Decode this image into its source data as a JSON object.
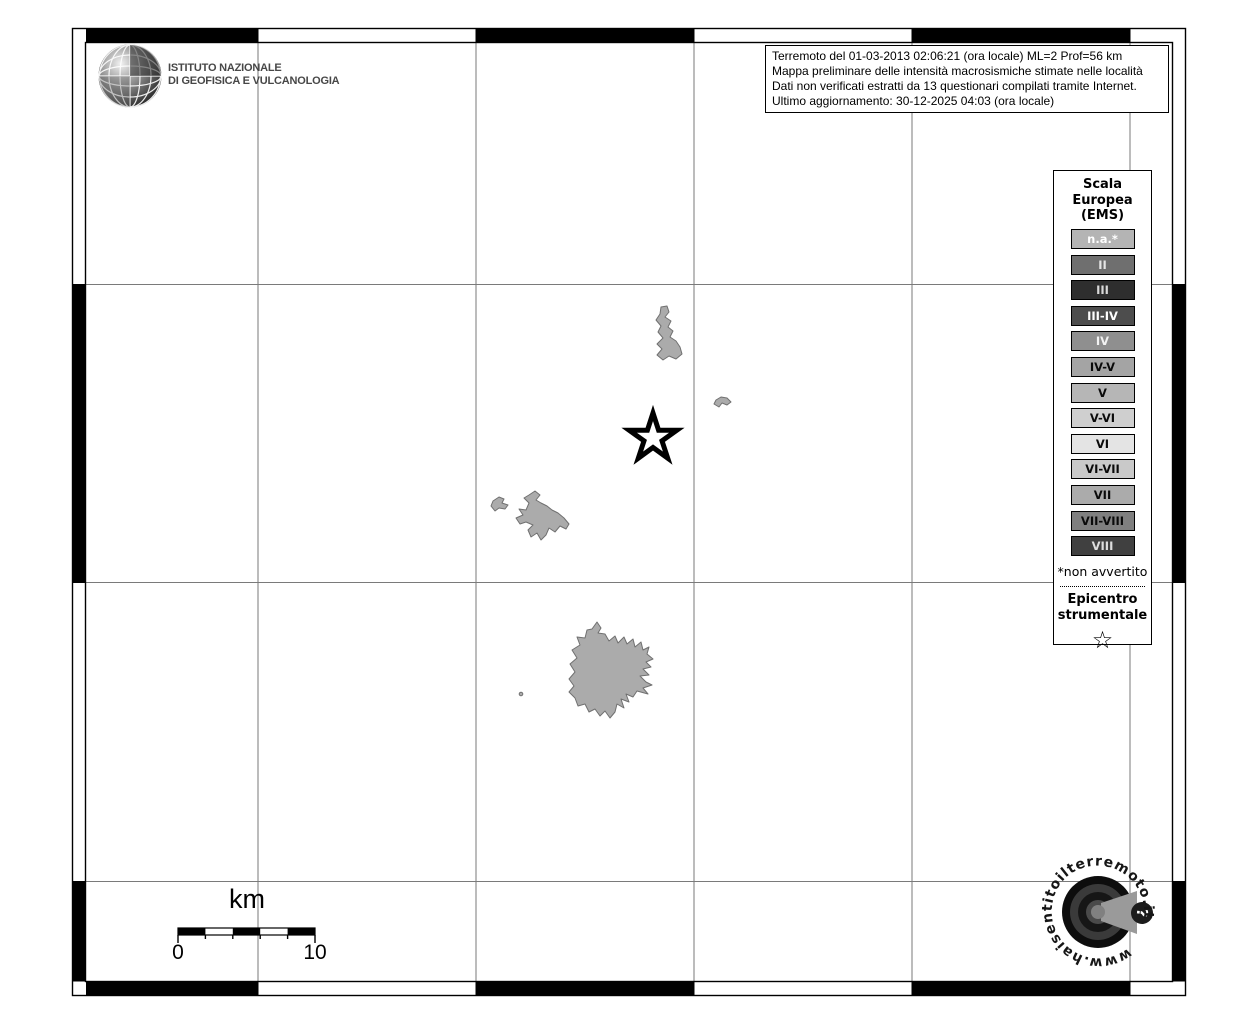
{
  "header": {
    "ingv_name_line1": "ISTITUTO NAZIONALE",
    "ingv_name_line2": "DI GEOFISICA E VULCANOLOGIA"
  },
  "info_box": {
    "line1": "Terremoto del 01-03-2013 02:06:21 (ora locale) ML=2 Prof=56 km",
    "line2": "Mappa preliminare delle intensità macrosismiche stimate nelle località",
    "line3": "Dati non verificati estratti da 13 questionari compilati tramite Internet.",
    "line4": "Ultimo aggiornamento: 30-12-2025 04:03 (ora locale)"
  },
  "legend": {
    "title_line1": "Scala",
    "title_line2": "Europea",
    "title_line3": "(EMS)",
    "items": [
      {
        "label": "n.a.*",
        "bg": "#b4b4b4",
        "fg": "#ffffff"
      },
      {
        "label": "II",
        "bg": "#6f6f6f",
        "fg": "#e6e6e6"
      },
      {
        "label": "III",
        "bg": "#2e2e2e",
        "fg": "#d9d9d9"
      },
      {
        "label": "III-IV",
        "bg": "#4d4d4d",
        "fg": "#ffffff"
      },
      {
        "label": "IV",
        "bg": "#8f8f8f",
        "fg": "#f2f2f2"
      },
      {
        "label": "IV-V",
        "bg": "#a4a4a4",
        "fg": "#0a0a0a"
      },
      {
        "label": "V",
        "bg": "#b6b6b6",
        "fg": "#0a0a0a"
      },
      {
        "label": "V-VI",
        "bg": "#cfcfcf",
        "fg": "#0a0a0a"
      },
      {
        "label": "VI",
        "bg": "#e4e4e4",
        "fg": "#0a0a0a"
      },
      {
        "label": "VI-VII",
        "bg": "#c9c9c9",
        "fg": "#0a0a0a"
      },
      {
        "label": "VII",
        "bg": "#ababab",
        "fg": "#0a0a0a"
      },
      {
        "label": "VII-VIII",
        "bg": "#7f7f7f",
        "fg": "#0a0a0a"
      },
      {
        "label": "VIII",
        "bg": "#404040",
        "fg": "#dedede"
      }
    ],
    "footnote": "*non avvertito",
    "epicenter_line1": "Epicentro",
    "epicenter_line2": "strumentale",
    "epicenter_star": "☆"
  },
  "axes": {
    "top": [
      "10°36'",
      "10°48'",
      "11°00'",
      "11°12'",
      "11°24'"
    ],
    "bottom": [
      "10°36'",
      "10°48'",
      "11°00'",
      "11°12'",
      "11°24'"
    ],
    "left": [
      "44°12'",
      "44°00'",
      "43°48'"
    ],
    "right": [
      "44°12'",
      "44°00'",
      "43°48'"
    ]
  },
  "scale_bar": {
    "unit": "km",
    "start": "0",
    "end": "10"
  },
  "watermark": {
    "url_text": "www.haisentitoilterremoto.it",
    "question_mark": "?"
  },
  "colors": {
    "locality_fill": "#ababab",
    "locality_stroke": "#707070",
    "gridline": "#7a7a7a",
    "frame": "#000000"
  }
}
